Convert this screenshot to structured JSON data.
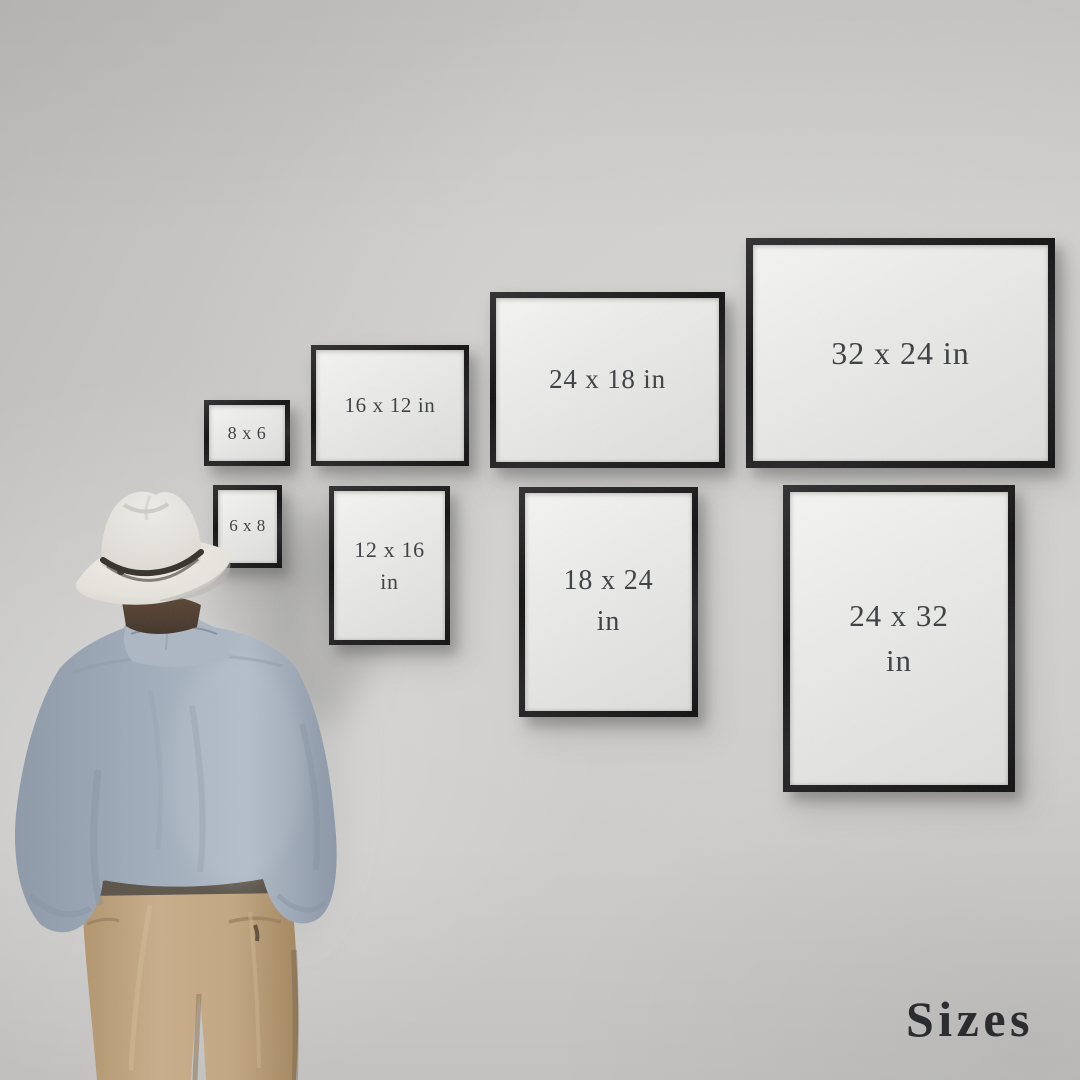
{
  "title": "Sizes",
  "frames": [
    {
      "id": "8x6",
      "line1": "8 x 6",
      "line2": ""
    },
    {
      "id": "6x8",
      "line1": "6 x 8",
      "line2": ""
    },
    {
      "id": "16x12",
      "line1": "16 x 12 in",
      "line2": ""
    },
    {
      "id": "12x16",
      "line1": "12 x 16",
      "line2": "in"
    },
    {
      "id": "24x18",
      "line1": "24 x 18 in",
      "line2": ""
    },
    {
      "id": "18x24",
      "line1": "18 x 24",
      "line2": "in"
    },
    {
      "id": "32x24",
      "line1": "32 x 24 in",
      "line2": ""
    },
    {
      "id": "24x32",
      "line1": "24 x 32",
      "line2": "in"
    }
  ],
  "figure": {
    "description": "man seen from behind wearing a white fedora, light blue shirt and khaki trousers, looking at the framed size chart"
  },
  "colors": {
    "wall": "#cfcecd",
    "frame_border": "#19191b",
    "frame_paper": "#eaeae8",
    "label_text": "#3c3f43",
    "title_text": "#26272a",
    "hat": "#e9e7e1",
    "hat_band": "#36312b",
    "hair": "#4e3c30",
    "shirt": "#9fabb9",
    "trousers": "#c2a683"
  }
}
